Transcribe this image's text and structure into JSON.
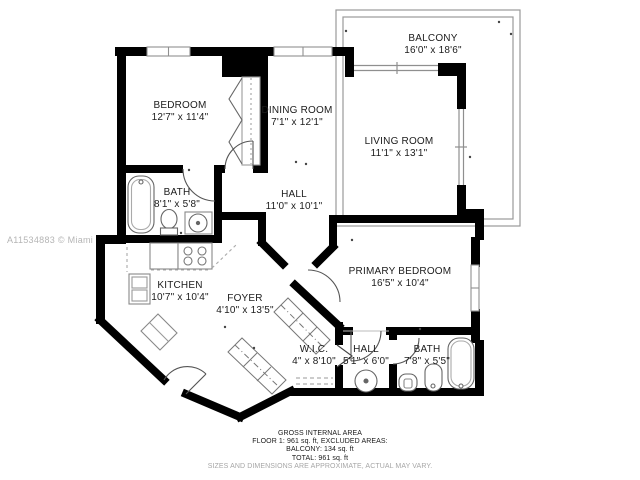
{
  "watermark": "A11534883 © Miami MLS® 2024",
  "rooms": [
    {
      "id": "bedroom",
      "name": "BEDROOM",
      "dims": "12'7\" x 11'4\""
    },
    {
      "id": "dining-room",
      "name": "DINING ROOM",
      "dims": "7'1\" x 12'1\""
    },
    {
      "id": "living-room",
      "name": "LIVING ROOM",
      "dims": "11'1\" x 13'1\""
    },
    {
      "id": "balcony",
      "name": "BALCONY",
      "dims": "16'0\" x 18'6\""
    },
    {
      "id": "bath-top",
      "name": "BATH",
      "dims": "8'1\" x 5'8\""
    },
    {
      "id": "hall-main",
      "name": "HALL",
      "dims": "11'0\" x 10'1\""
    },
    {
      "id": "kitchen",
      "name": "KITCHEN",
      "dims": "10'7\" x 10'4\""
    },
    {
      "id": "foyer",
      "name": "FOYER",
      "dims": "4'10\" x 13'5\""
    },
    {
      "id": "primary-bedroom",
      "name": "PRIMARY BEDROOM",
      "dims": "16'5\" x 10'4\""
    },
    {
      "id": "wic",
      "name": "W.I.C.",
      "dims": "4\" x 8'10\""
    },
    {
      "id": "hall-bottom",
      "name": "HALL",
      "dims": "5'1\" x 6'0\""
    },
    {
      "id": "bath-bottom",
      "name": "BATH",
      "dims": "7'8\" x 5'5\""
    }
  ],
  "footer": {
    "line1": "GROSS INTERNAL AREA",
    "line2": "FLOOR 1: 961 sq. ft, EXCLUDED AREAS:",
    "line3": "BALCONY: 134 sq. ft",
    "line4": "TOTAL: 961 sq. ft",
    "disclaimer": "SIZES AND DIMENSIONS ARE APPROXIMATE, ACTUAL MAY VARY."
  },
  "colors": {
    "wall": "#000000",
    "thin_line": "#8f8f8f",
    "fixture_line": "#666666",
    "label_text": "#1c1c1c",
    "watermark_text": "#b5b5b5",
    "disclaimer_text": "#a6a6a6",
    "background": "#ffffff"
  }
}
